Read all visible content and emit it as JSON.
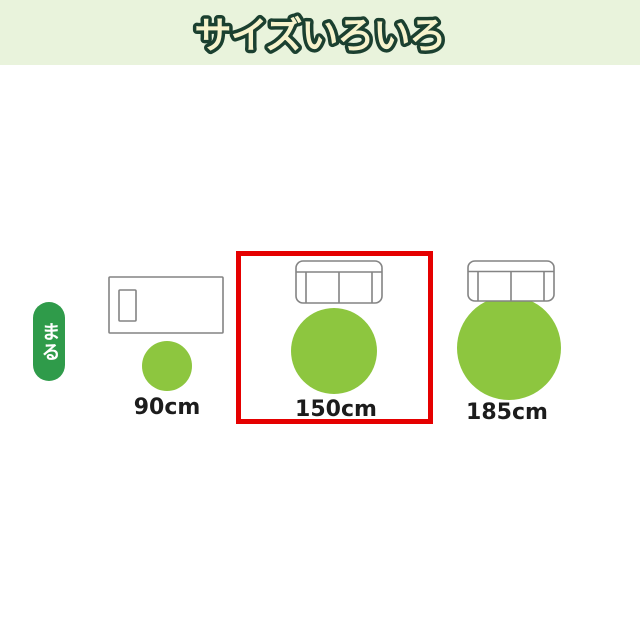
{
  "header": {
    "title": "サイズいろいろ"
  },
  "badge": {
    "label": "まる"
  },
  "options": [
    {
      "label": "90cm",
      "size_cm": 90,
      "furniture": "single-bed",
      "rug_shape": "round",
      "highlighted": false
    },
    {
      "label": "150cm",
      "size_cm": 150,
      "furniture": "two-seat-sofa",
      "rug_shape": "round",
      "highlighted": true
    },
    {
      "label": "185cm",
      "size_cm": 185,
      "furniture": "two-seat-sofa",
      "rug_shape": "round",
      "highlighted": false
    }
  ],
  "colors": {
    "header_bg": "#e9f3dc",
    "title_fill": "#f7f3cc",
    "title_outline": "#1b4030",
    "badge_green": "#2f9b4a",
    "rug_green": "#8dc63f",
    "highlight_red": "#e50000",
    "furniture_outline": "#848484",
    "label_text": "#1c1c1c"
  }
}
